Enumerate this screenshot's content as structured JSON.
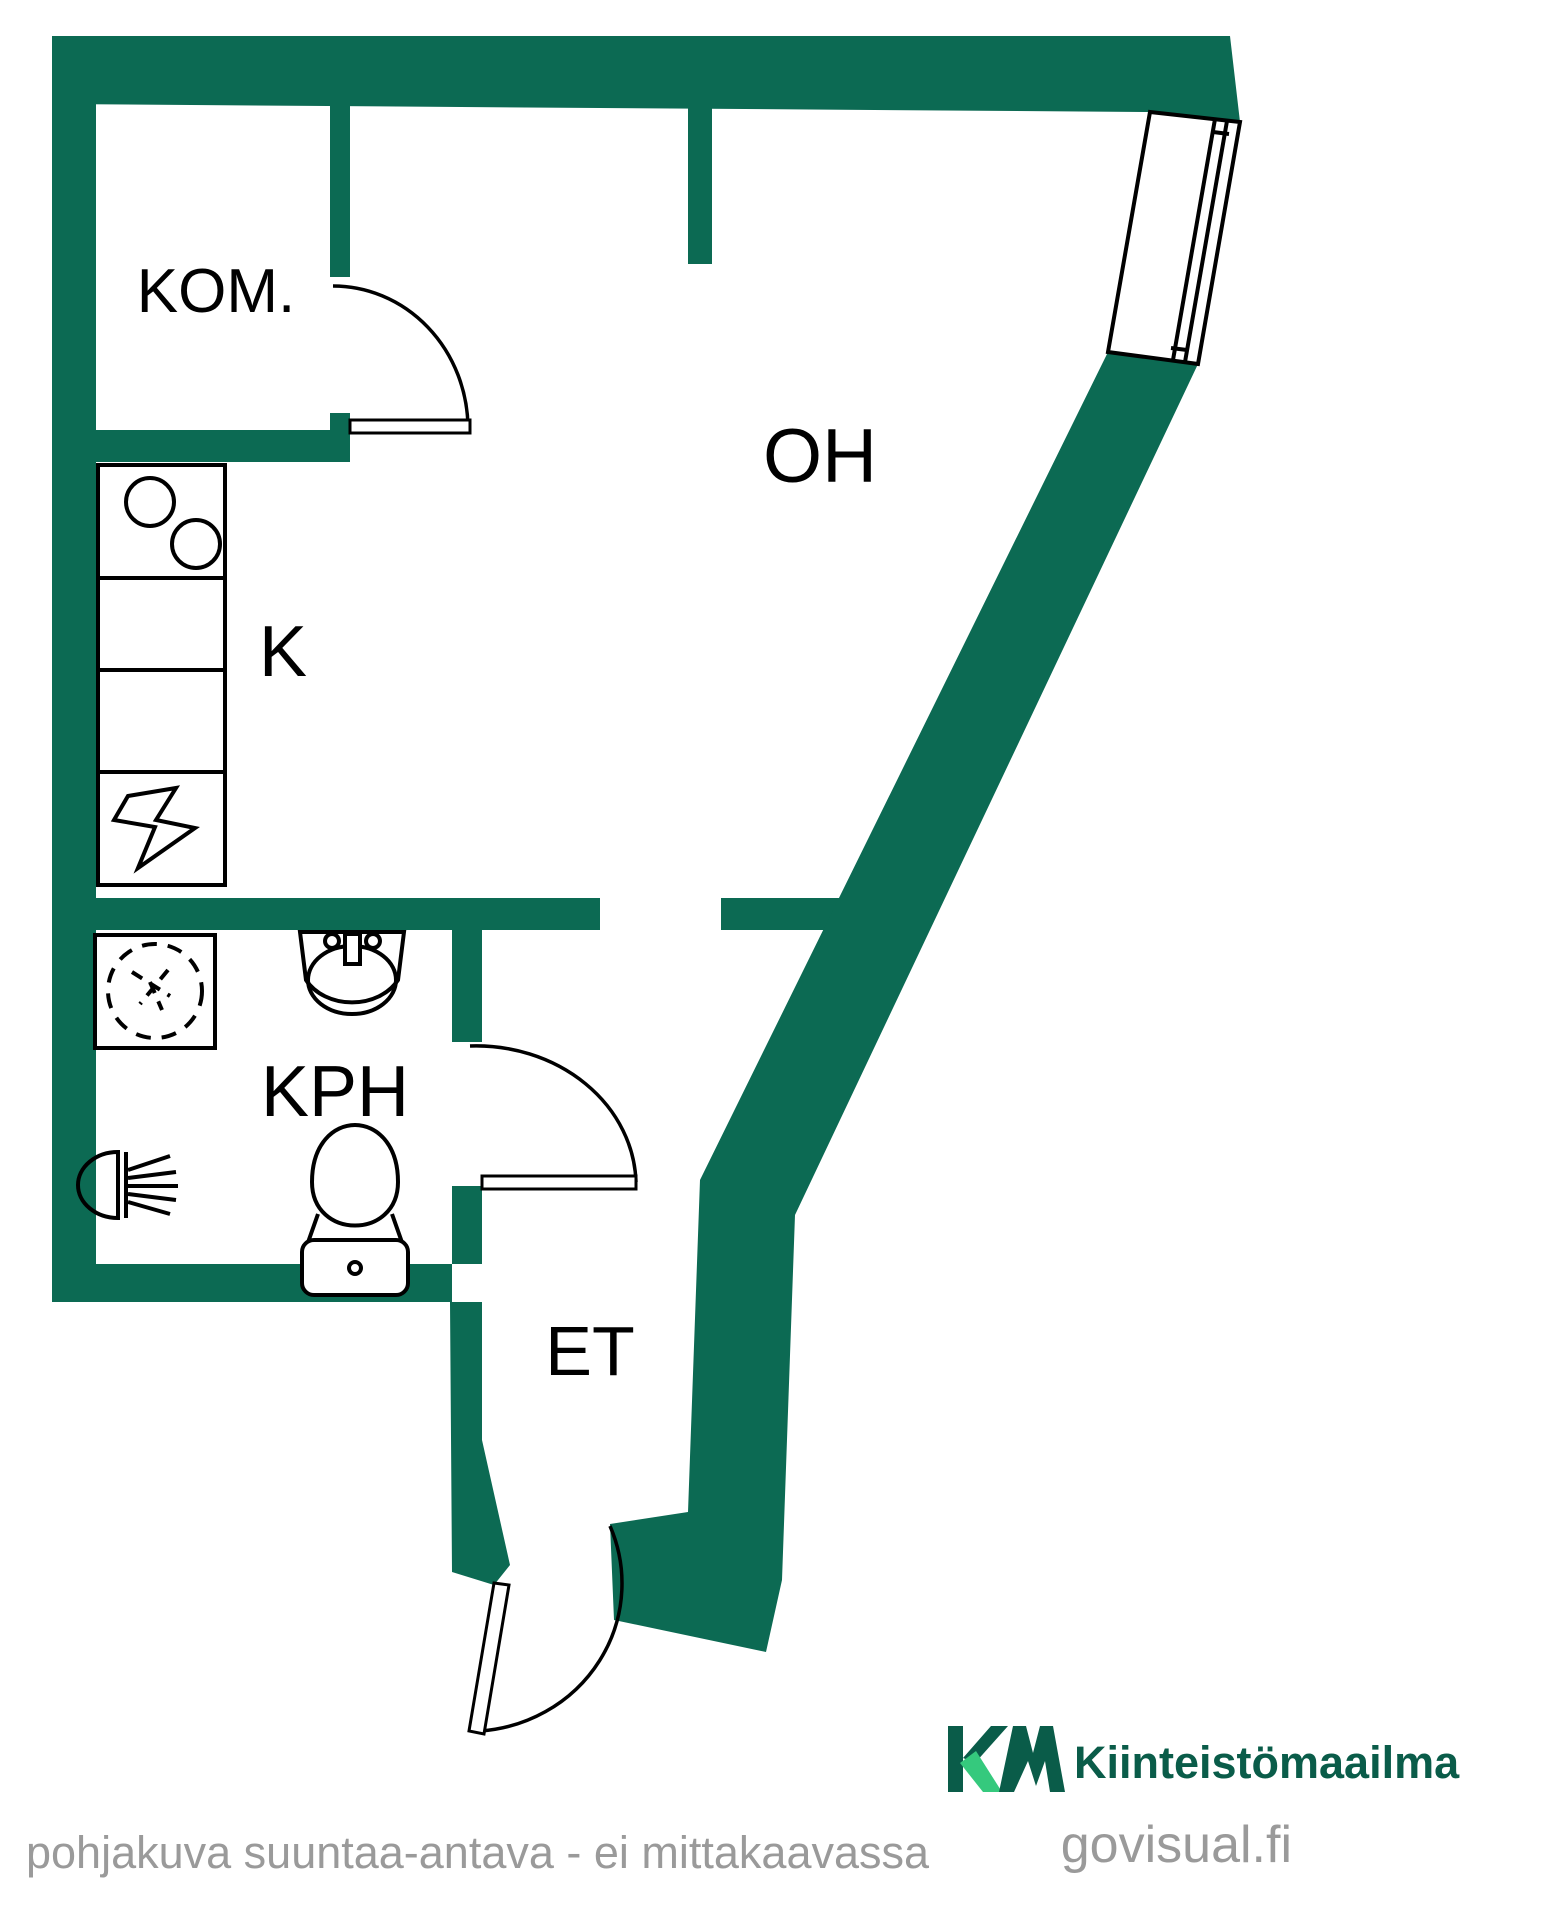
{
  "plan": {
    "type": "apartment-floor-plan",
    "rooms": {
      "kom": {
        "label": "KOM.",
        "meaning": "closet"
      },
      "oh": {
        "label": "OH",
        "meaning": "living room"
      },
      "k": {
        "label": "K",
        "meaning": "kitchen"
      },
      "kph": {
        "label": "KPH",
        "meaning": "bathroom"
      },
      "et": {
        "label": "ET",
        "meaning": "entry hall"
      }
    },
    "fixtures": [
      "stove-icon",
      "counter-cabinet",
      "counter-cabinet",
      "electrical-cabinet-icon",
      "washing-machine-icon",
      "ceiling-lamp-icon",
      "sink-icon",
      "toilet-icon",
      "window",
      "door-arc",
      "door-arc",
      "door-arc"
    ],
    "colors": {
      "wall": "#0c6a53",
      "line": "#000000",
      "background": "#ffffff"
    }
  },
  "branding": {
    "logo_monogram": "KM",
    "logo_text": "Kiinteistömaailma",
    "watermark": "govisual.fi",
    "logo_dark": "#0a5c49",
    "logo_bright": "#35c97d",
    "watermark_color": "#a6a6a6"
  },
  "footer": {
    "disclaimer": "pohjakuva suuntaa-antava - ei mittakaavassa",
    "disclaimer_color": "#9a9a9a"
  }
}
